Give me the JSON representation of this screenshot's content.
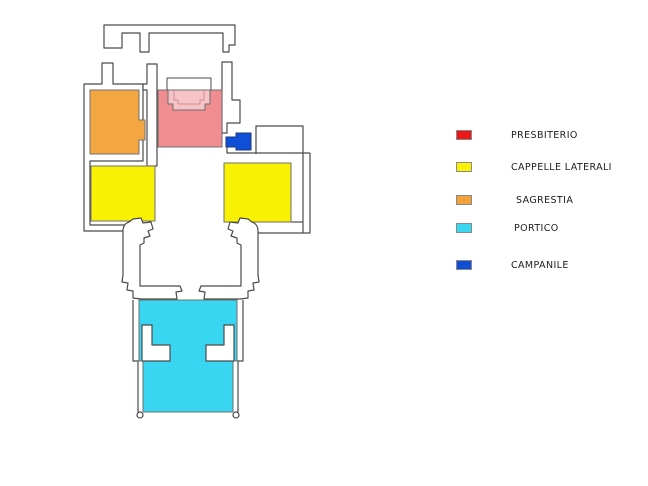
{
  "legend": {
    "items": [
      {
        "id": "presbiterio",
        "label": "PRESBITERIO",
        "color": "#ee1717"
      },
      {
        "id": "cappelle-laterali",
        "label": "CAPPELLE LATERALI",
        "color": "#f8f104"
      },
      {
        "id": "sagrestia",
        "label": "SAGRESTIA",
        "color": "#f4a238"
      },
      {
        "id": "portico",
        "label": "PORTICO",
        "color": "#38d6f0"
      },
      {
        "id": "campanile",
        "label": "CAMPANILE",
        "color": "#0f4fd8"
      }
    ]
  },
  "plan": {
    "background": "#ffffff",
    "wall_color": "#4b4b4b",
    "regions": [
      {
        "id": "presbiterio",
        "color": "#f08d90"
      },
      {
        "id": "apse-platform",
        "color": "#f6c3c6"
      },
      {
        "id": "sagrestia",
        "color": "#f4a741"
      },
      {
        "id": "cappella-sinistra",
        "color": "#f8f104"
      },
      {
        "id": "cappella-destra",
        "color": "#f8f104"
      },
      {
        "id": "portico",
        "color": "#38d6f0"
      },
      {
        "id": "campanile",
        "color": "#0f4fd8"
      }
    ]
  }
}
